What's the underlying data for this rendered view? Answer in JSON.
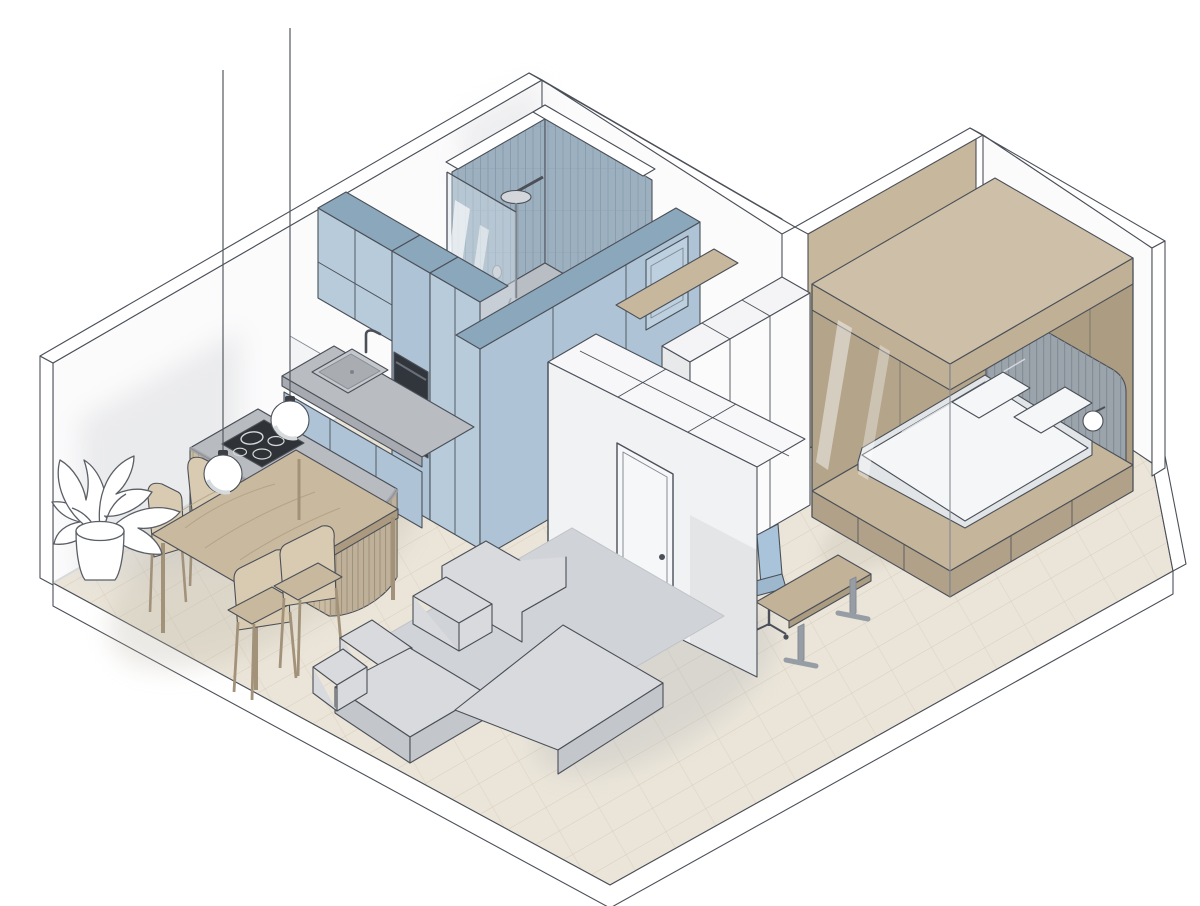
{
  "meta": {
    "title": "Isometric 3D cutaway floor plan of a studio apartment",
    "render_style": "architectural axonometric illustration",
    "visible_text": "none"
  },
  "palette": {
    "bg": "#ffffff",
    "line": "#4b5058",
    "line_soft": "#878c94",
    "floor": "#ebe5d9",
    "floor_line": "#d7cebd",
    "rim": "#ffffff",
    "wall_white": "#fbfbfc",
    "wall_band": "#ffffff",
    "wall_shadow": "#c9cbce",
    "tan_wall": "#c7b79d",
    "cab_front": "#b7cbdb",
    "cab_front2": "#aec4d6",
    "cab_side": "#9fb9cd",
    "cab_top": "#8ba7bc",
    "tile": "#9db0bf",
    "tile_stripe": "#879dae",
    "shower_floor": "#b9bec4",
    "glass": "#dce8f0",
    "counter": "#b9bcc1",
    "counter_side": "#a7abb1",
    "oven": "#31363d",
    "oven_trim": "#6a7079",
    "island_wood": "#cabba3",
    "island_slat": "#ac9c83",
    "island_top": "#b8bbc0",
    "island_top_edge": "#9fa3a8",
    "cooktop": "#2f3338",
    "table_top": "#c9b99f",
    "table_grain": "#ab9a7f",
    "chair_seat": "#d9cbb1",
    "chair_shade": "#c8b99e",
    "chair_leg": "#a2927a",
    "sofa": "#d8dadd",
    "sofa_shade": "#c3c6cb",
    "rug": "#d0d3d7",
    "box_top": "#cec0a8",
    "box_fascia": "#c0b096",
    "box_inner": "#ab9c82",
    "box_inner2": "#b3a48a",
    "platform": "#c4b59b",
    "platform_side": "#b0a188",
    "headboard": "#9ba3ab",
    "headboard_stripe": "#848e98",
    "bed": "#f5f6f7",
    "bed_shade": "#e2e5e8",
    "desk_top": "#c2b298",
    "metal": "#979da5",
    "chair_office": "#a9c4da",
    "lamp": "#ffffff",
    "lamp_shade": "#d7dadd"
  },
  "scene": {
    "rooms": [
      {
        "name": "kitchen-dining",
        "items": [
          "blue-wall-cabinets",
          "stacked-double-oven",
          "sink-with-faucet",
          "grey-counter",
          "curved-slatted-island",
          "induction-cooktop",
          "two-pendant-lamps",
          "wooden-dining-table",
          "four-dining-chairs",
          "monstera-plant"
        ]
      },
      {
        "name": "shower-room",
        "items": [
          "striped-tiled-walls",
          "rain-shower-head",
          "glass-screen",
          "terrazzo-shower-floor",
          "blue-storage-surround",
          "bathroom-door"
        ]
      },
      {
        "name": "living-area",
        "items": [
          "grey-corner-sofa",
          "grey-rug",
          "entrance-storage-wall",
          "interior-door"
        ]
      },
      {
        "name": "bedroom",
        "items": [
          "tan-bed-canopy-box",
          "double-bed",
          "two-pillows",
          "slatted-headboard",
          "two-wall-sconces",
          "desk",
          "task-chair",
          "white-wardrobe"
        ]
      }
    ],
    "counts": {
      "dining_chairs": 4,
      "pendant_lamps": 2,
      "ovens": 2,
      "cooktop_burners": 4,
      "pillows": 2,
      "wall_sconces": 2
    }
  }
}
